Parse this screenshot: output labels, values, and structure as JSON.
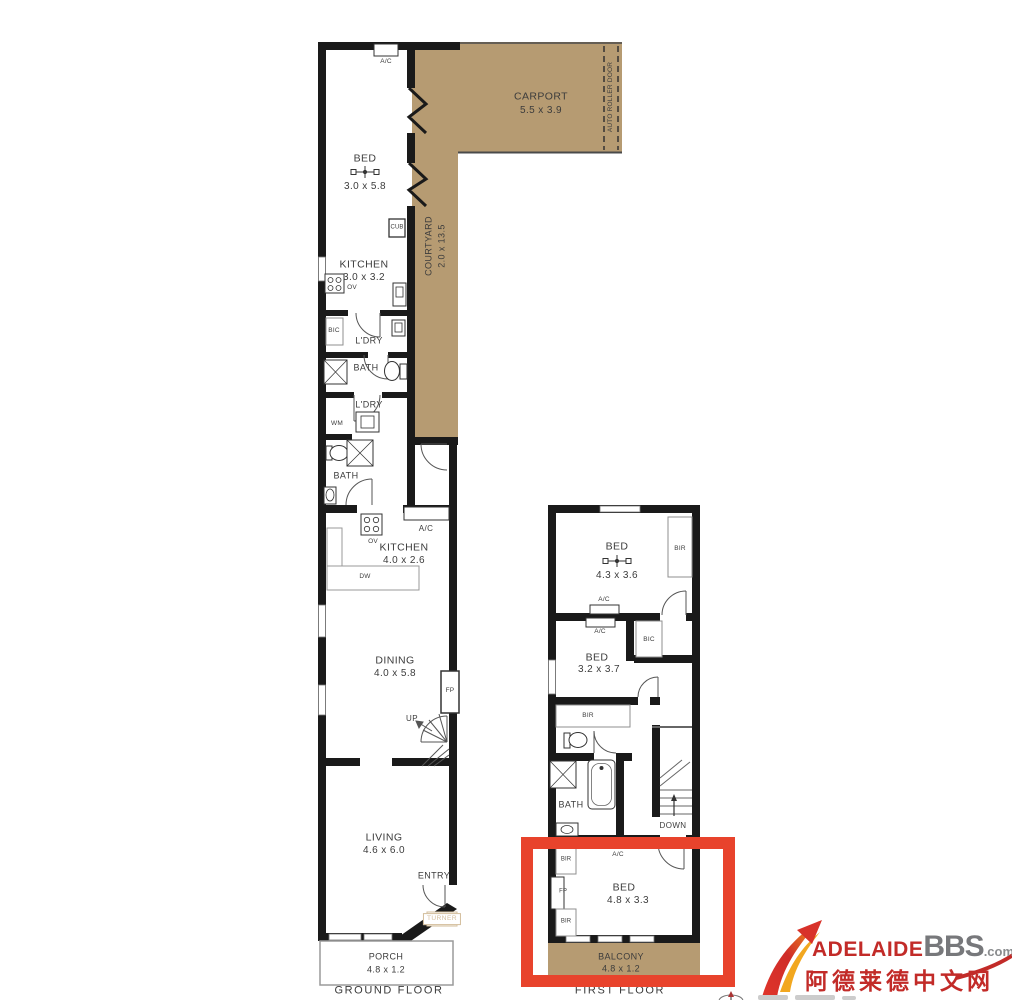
{
  "gf": {
    "floor": "GROUND FLOOR",
    "bed": "BED",
    "bed_d": "3.0 x 5.8",
    "ac_bed": "A/C",
    "carport": "CARPORT",
    "carport_d": "5.5 x 3.9",
    "auto_roller_door": "AUTO ROLLER DOOR",
    "courtyard": "COURTYARD",
    "courtyard_d": "2.0 x 13.5",
    "cub": "CUB",
    "kitchen1": "KITCHEN",
    "kitchen1_d": "3.0 x 3.2",
    "ov1": "OV",
    "bic": "BIC",
    "ldry1": "L'DRY",
    "bath1": "BATH",
    "ldry2": "L'DRY",
    "wm": "WM",
    "bath2": "BATH",
    "ac_kitchen": "A/C",
    "kitchen2": "KITCHEN",
    "kitchen2_d": "4.0 x 2.6",
    "ov2": "OV",
    "dw": "DW",
    "dining": "DINING",
    "dining_d": "4.0 x 5.8",
    "fp": "FP",
    "up": "UP",
    "living": "LIVING",
    "living_d": "4.6 x 6.0",
    "entry": "ENTRY",
    "turner": "TURNER",
    "porch": "PORCH",
    "porch_d": "4.8 x 1.2"
  },
  "ff": {
    "floor": "FIRST FLOOR",
    "bed1": "BED",
    "bed1_d": "4.3 x 3.6",
    "bir1": "BIR",
    "ac_upper": "A/C",
    "ac_lower": "A/C",
    "bed2": "BED",
    "bed2_d": "3.2 x 3.7",
    "bic": "BIC",
    "bir2": "BIR",
    "bath": "BATH",
    "down": "DOWN",
    "bir_top": "BIR",
    "fp": "FP",
    "bir_bottom": "BIR",
    "ac_bed": "A/C",
    "bed3": "BED",
    "bed3_d": "4.8 x 3.3",
    "balcony": "BALCONY",
    "balcony_d": "4.8 x 1.2"
  },
  "brand": {
    "name": "ADELAIDE",
    "suffix": "BBS",
    "tld": ".com",
    "tagline": "阿德莱德中文网"
  },
  "colors": {
    "floorplan_tan": "#b69b72",
    "wall_black": "#1a1a1a",
    "highlight_red": "#e8432c",
    "brand_red": "#c22b28",
    "brand_gray": "#77787b"
  }
}
